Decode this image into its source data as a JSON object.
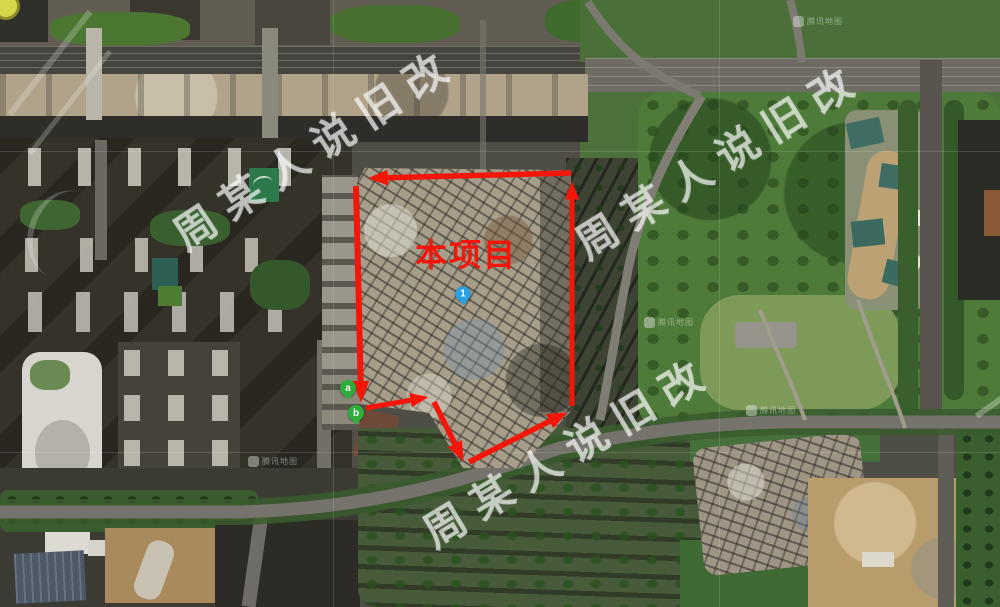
{
  "map": {
    "provider_mark": "腾讯地图",
    "provider_positions": [
      {
        "x": 793,
        "y": 16
      },
      {
        "x": 644,
        "y": 317
      },
      {
        "x": 746,
        "y": 405
      },
      {
        "x": 248,
        "y": 456
      }
    ],
    "watermark": {
      "text": "周某人说旧改",
      "color": "rgba(255,255,255,0.62)",
      "instances": [
        {
          "x": 314,
          "y": 146,
          "rot": -33.5
        },
        {
          "x": 718,
          "y": 158,
          "rot": -32
        },
        {
          "x": 567,
          "y": 449,
          "rot": -31
        }
      ]
    },
    "annotations": {
      "project_label": {
        "text": "本项目",
        "x": 466,
        "y": 253,
        "color": "#f5160a",
        "font_size": 32
      },
      "boundary": {
        "color": "#f5160a",
        "arrows": [
          {
            "x1": 571,
            "y1": 173,
            "x2": 374,
            "y2": 178,
            "w": 5.5
          },
          {
            "x1": 356,
            "y1": 186,
            "x2": 361,
            "y2": 396,
            "w": 6
          },
          {
            "x1": 366,
            "y1": 408,
            "x2": 423,
            "y2": 398,
            "w": 5
          },
          {
            "x1": 434,
            "y1": 402,
            "x2": 461,
            "y2": 456,
            "w": 5.5
          },
          {
            "x1": 469,
            "y1": 462,
            "x2": 562,
            "y2": 415,
            "w": 5.5
          },
          {
            "x1": 572,
            "y1": 406,
            "x2": 572,
            "y2": 187,
            "w": 5
          }
        ]
      },
      "markers": [
        {
          "label": "1",
          "x": 463,
          "y": 294,
          "fill": "#29a0e6",
          "style": "blue"
        },
        {
          "label": "a",
          "x": 348,
          "y": 388,
          "fill": "#2fad3a",
          "style": "green"
        },
        {
          "label": "b",
          "x": 356,
          "y": 413,
          "fill": "#2fad3a",
          "style": "green"
        }
      ]
    }
  }
}
